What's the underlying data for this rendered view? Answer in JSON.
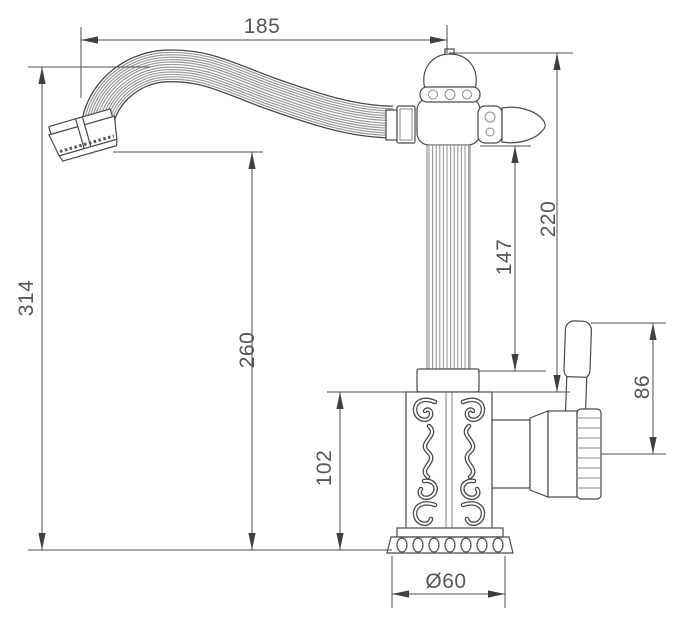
{
  "drawing": {
    "subject": "Ornate classical single-handle faucet - dimensioned technical side elevation",
    "background": "#ffffff",
    "line_color": "#4a4a4a",
    "dimension_line_color": "#4f4f4f",
    "text_color": "#565656"
  },
  "dimensions": {
    "spout_reach": "185",
    "overall_height": "314",
    "spout_outlet_height": "260",
    "spout_to_collar": "147",
    "top_to_body_shoulder": "220",
    "base_body_height": "102",
    "handle_length": "86",
    "base_diameter": "Ø60"
  }
}
